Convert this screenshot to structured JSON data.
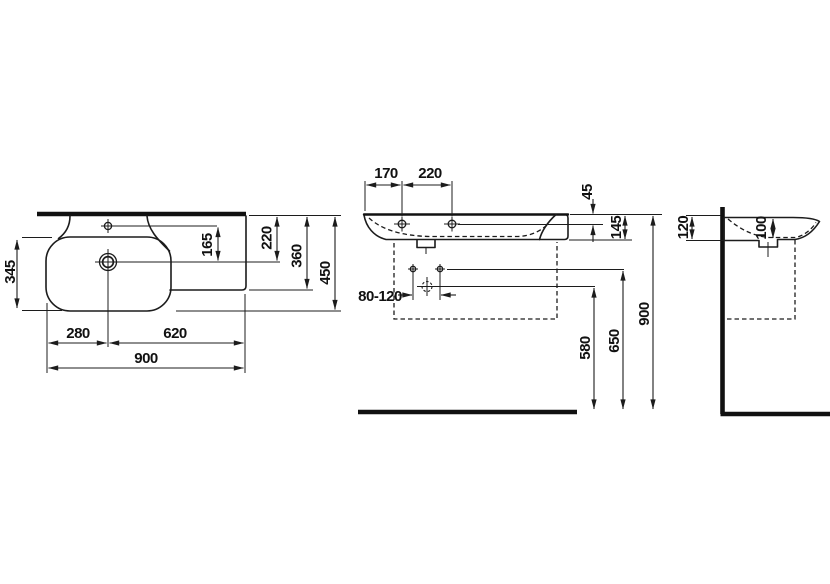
{
  "drawing": {
    "product": "wall-hung washbasin with shelf",
    "background_color": "#ffffff",
    "line_color": "#1c1c1c",
    "views": {
      "top": {
        "name": "top view",
        "dims": {
          "bowl_depth": "345",
          "tap_to_drain": "165",
          "drain_depth": "220",
          "shelf_depth": "360",
          "overall_depth": "450",
          "bowl_center_offset": "280",
          "shelf_span": "620",
          "overall_width": "900"
        }
      },
      "front": {
        "name": "front view",
        "dims": {
          "tap_hole_offset": "170",
          "tap_hole_spacing": "220",
          "shelf_edge_thickness": "45",
          "rim_edge_height": "145",
          "fixing_bolt_spacing": "80-120",
          "drain_outlet_height": "580",
          "fixing_bolt_height": "650",
          "rim_height": "900"
        }
      },
      "side": {
        "name": "side view",
        "dims": {
          "back_rim_height": "120",
          "bowl_inner_depth": "100"
        }
      }
    }
  }
}
